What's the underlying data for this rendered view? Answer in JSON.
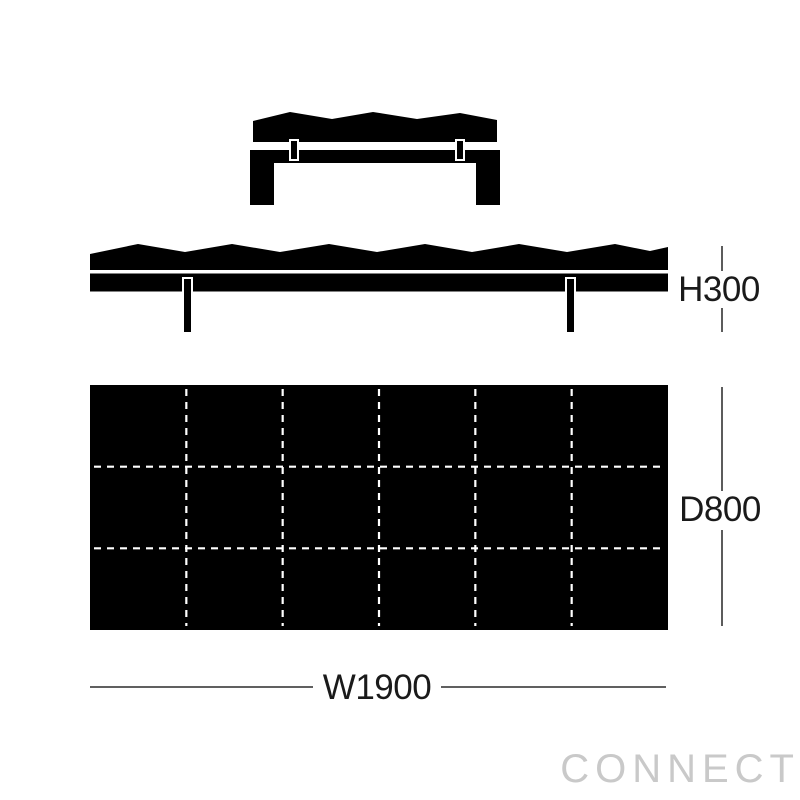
{
  "diagram": {
    "type": "furniture-dimension-drawing",
    "views": {
      "end_view": {
        "name": "end elevation"
      },
      "side_view": {
        "name": "side elevation"
      },
      "plan_view": {
        "name": "top plan",
        "grid_columns": 6,
        "grid_rows": 3
      }
    },
    "dimensions": {
      "height": {
        "label": "H300"
      },
      "depth": {
        "label": "D800"
      },
      "width": {
        "label": "W1900"
      }
    },
    "watermark": {
      "text": "CONNECT",
      "color": "#c9c9c9"
    },
    "colors": {
      "figure": "#000000",
      "background": "#ffffff",
      "grid_dash": "#ffffff",
      "dimension_line": "#4a4a4a",
      "dimension_text": "#1a1a1a"
    }
  }
}
